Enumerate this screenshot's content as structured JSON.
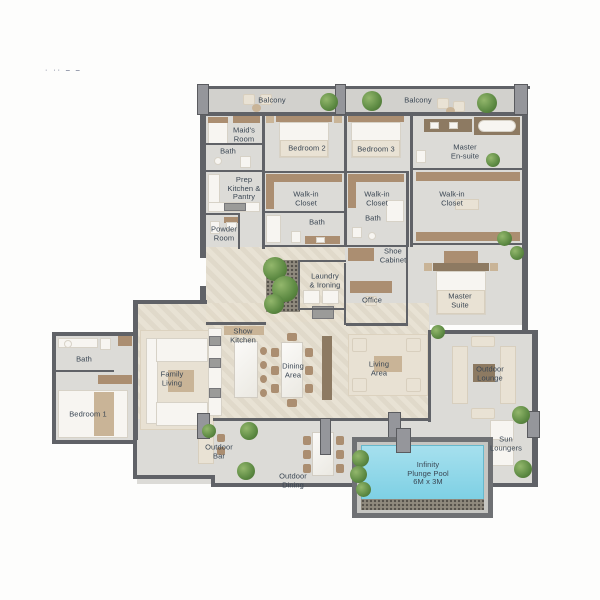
{
  "meta": {
    "corner_marks": "· ·· – –"
  },
  "labels": {
    "balcony_left": "Balcony",
    "balcony_right": "Balcony",
    "maids_room": "Maid's\nRoom",
    "bath_maids": "Bath",
    "bedroom2": "Bedroom 2",
    "bedroom3": "Bedroom 3",
    "master_ensuite": "Master\nEn-suite",
    "prep_kitchen": "Prep\nKitchen &\nPantry",
    "wic_bed2": "Walk-in\nCloset",
    "bath_bed2": "Bath",
    "powder_room": "Powder\nRoom",
    "wic_bed3": "Walk-in\nCloset",
    "wic_master": "Walk-in\nCloset",
    "bath_bed3": "Bath",
    "shoe_cabinet": "Shoe\nCabinet",
    "laundry": "Laundry\n& Ironing",
    "office": "Office",
    "master_suite": "Master\nSuite",
    "bath_bed1": "Bath",
    "family_living": "Family\nLiving",
    "bedroom1": "Bedroom 1",
    "show_kitchen": "Show\nKitchen",
    "dining_area": "Dining\nArea",
    "living_area": "Living\nArea",
    "outdoor_lounge": "Outdoor\nLounge",
    "sun_loungers": "Sun\nLoungers",
    "outdoor_bar": "Outdoor\nBar",
    "outdoor_dining": "Outdoor\nDining",
    "infinity_pool": "Infinity\nPlunge Pool\n6M x 3M"
  },
  "colors": {
    "wall": "#606267",
    "column": "#95969b",
    "floor": "#dcdbd7",
    "floor_herringbone": "#e7dfd0",
    "furniture_tan": "#ab8e71",
    "furniture_white": "#f7f5f1",
    "plant_green": "#5d8a43",
    "pool_water": "#8fd6e8",
    "label_text": "#3a4653"
  }
}
